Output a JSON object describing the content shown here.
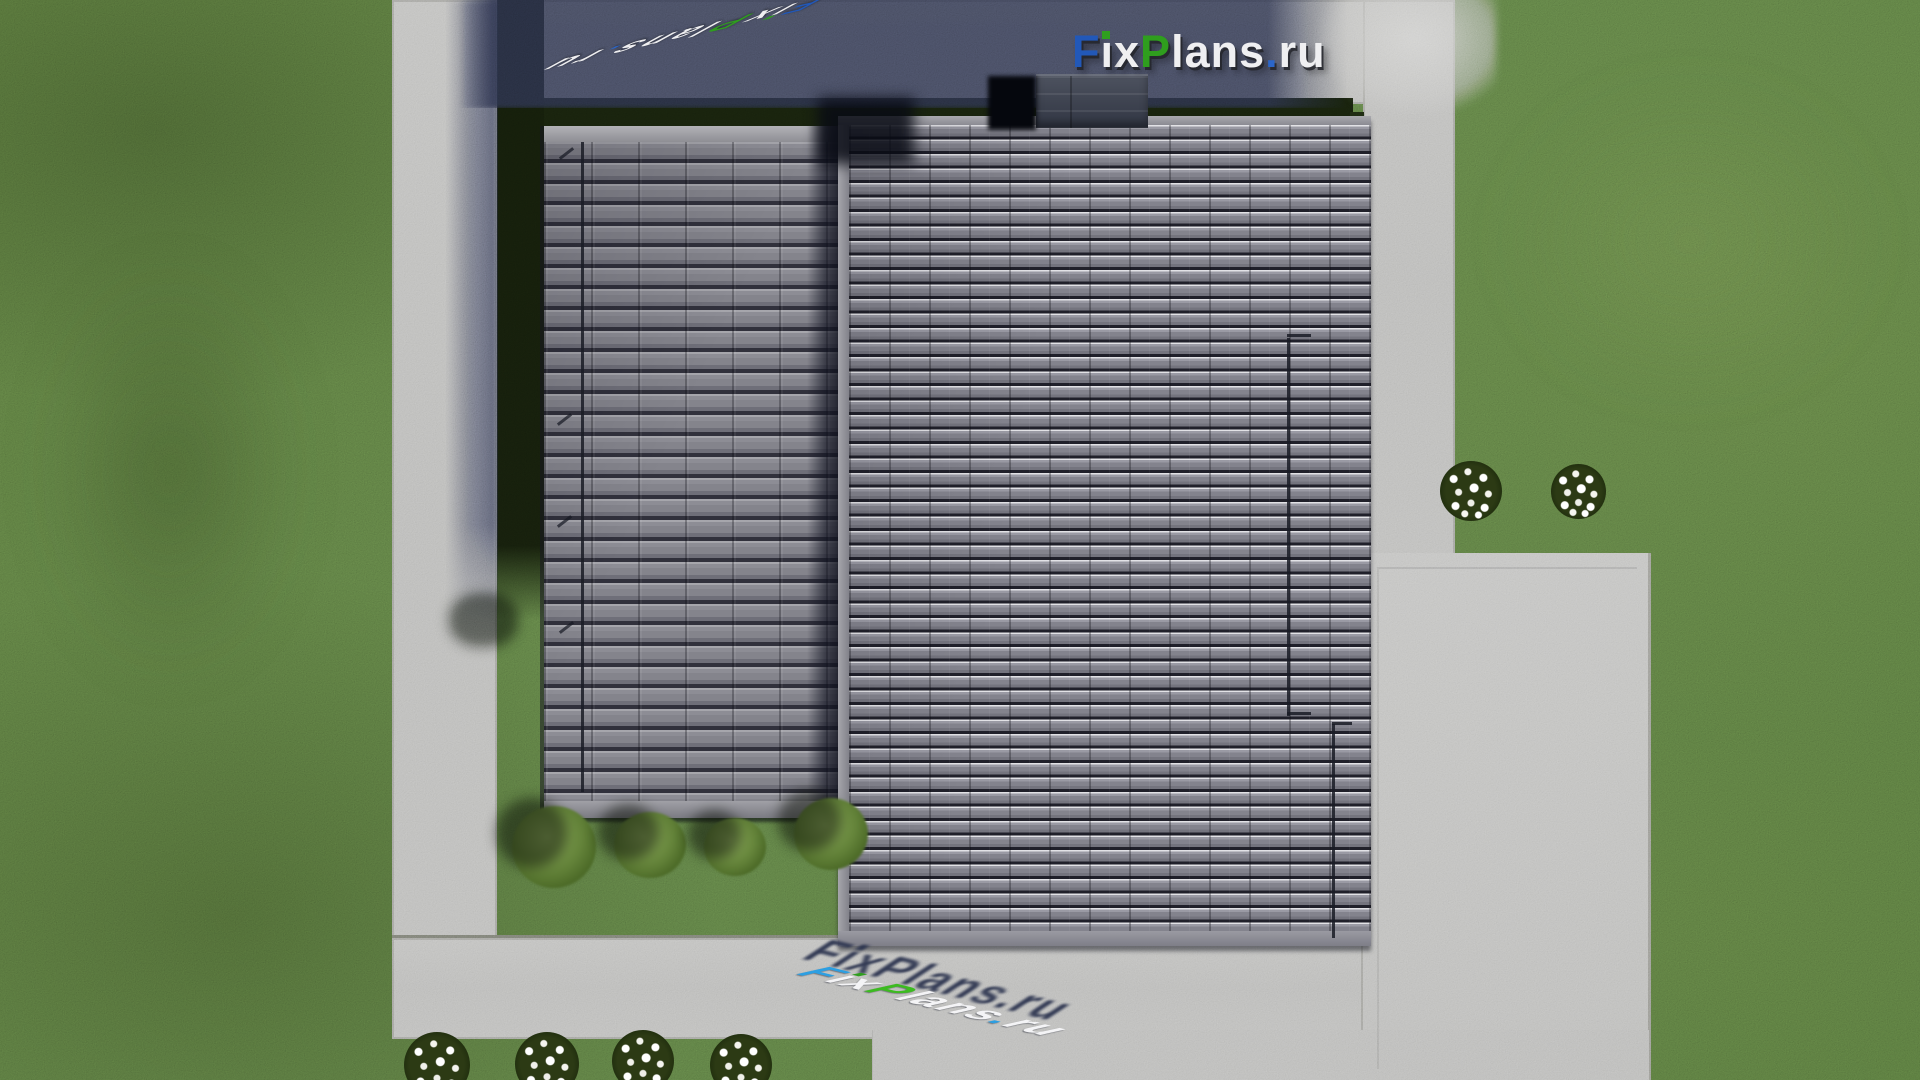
{
  "scene": {
    "description": "Aerial top-down 3D render of a house with dark grey tiled roof, concrete walkways and driveway, green lawn, shrubs and white flower bushes, watermarked FixPlans.ru"
  },
  "brand": {
    "name": "FixPlans.ru",
    "parts": [
      {
        "t": "F",
        "c": "#2258b8"
      },
      {
        "t": "ı",
        "c": "#efeff1"
      },
      {
        "t": "x",
        "c": "#efeff1"
      },
      {
        "t": "P",
        "c": "#2f9e1e"
      },
      {
        "t": "lans",
        "c": "#efeff1"
      },
      {
        "t": ".",
        "c": "#2b66c9"
      },
      {
        "t": "ru",
        "c": "#efeff1"
      }
    ],
    "ground_parts": [
      {
        "t": "F",
        "c": "#2c9fe2"
      },
      {
        "t": "ı",
        "c": "#f4f4f6"
      },
      {
        "t": "x",
        "c": "#f4f4f6"
      },
      {
        "t": "P",
        "c": "#3cbb20"
      },
      {
        "t": "lans",
        "c": "#f4f4f6"
      },
      {
        "t": ".",
        "c": "#2c9fe2"
      },
      {
        "t": "ru",
        "c": "#f4f4f6"
      }
    ]
  },
  "palette": {
    "grass": "#57743c",
    "grass_shadow": "#161f0c",
    "concrete": "#b8b8b6",
    "concrete_shadow": "#5a5e70",
    "roof_tile": "#80808a",
    "roof_tile_gap": "#262630",
    "roof_highlight": "#e2e2e6",
    "fascia": "#9a9aa0",
    "chimney": "#3d424f",
    "ground_shadow_navy": "#2d3550",
    "logo_blue": "#2258b8",
    "logo_green": "#2f9e1e",
    "ground_blue": "#2c9fe2"
  }
}
